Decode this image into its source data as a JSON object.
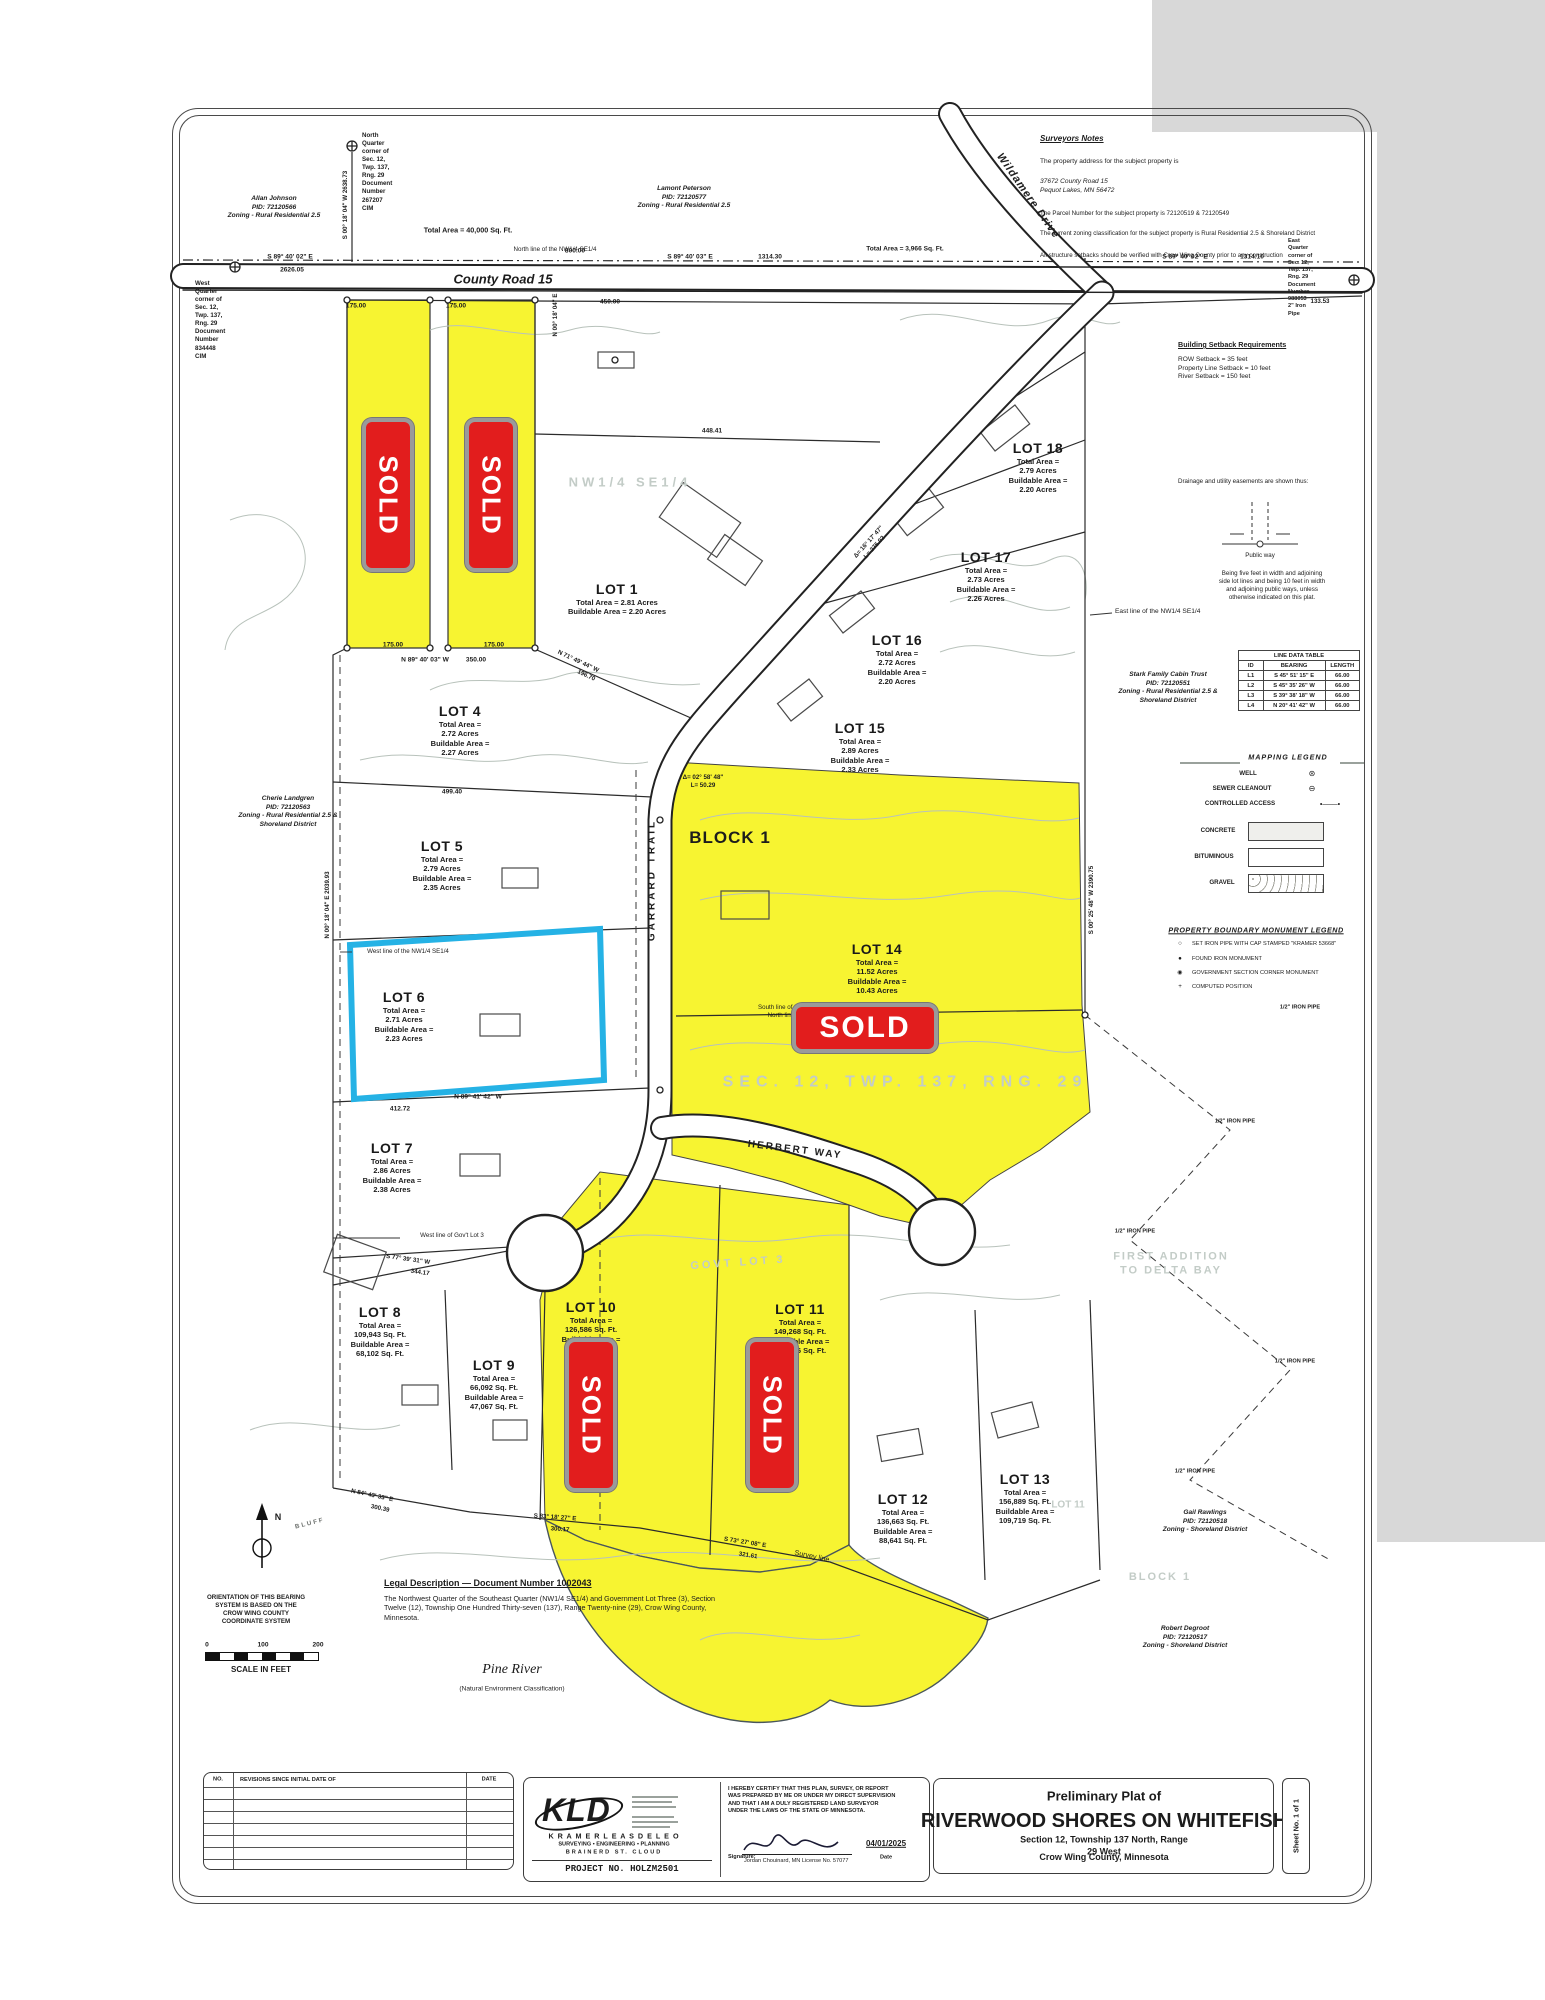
{
  "meta": {
    "title_block": {
      "pre": "Preliminary Plat of",
      "main": "RIVERWOOD SHORES ON WHITEFISH",
      "sub1": "Section 12, Township 137 North, Range 29 West",
      "sub2": "Crow Wing County, Minnesota"
    },
    "sheet_no": "Sheet No. 1 of 1"
  },
  "firm": {
    "kld": "KLD",
    "name": "K R A M E R    L E A S    D E L E O",
    "services": "SURVEYING  •  ENGINEERING  •  PLANNING",
    "offices": "BRAINERD        ST. CLOUD",
    "project": "PROJECT NO.   HOLZM2501",
    "cert": "I HEREBY CERTIFY THAT THIS PLAN, SURVEY, OR REPORT\nWAS PREPARED BY ME OR UNDER MY DIRECT SUPERVISION\nAND THAT I AM A DULY REGISTERED LAND SURVEYOR\nUNDER THE LAWS OF THE  STATE OF MINNESOTA.",
    "sig_label": "Signature:",
    "sig_name": "Jordan Chouinard,  MN License No. 57077",
    "date_value": "04/01/2025",
    "date_label": "Date"
  },
  "revisions": {
    "no": "NO.",
    "desc": "REVISIONS SINCE INITIAL DATE OF",
    "date": "DATE"
  },
  "surveyor": {
    "title": "Surveyors Notes",
    "l1": "The property address for the subject property is",
    "l2": "37672 County Road 15\nPequot Lakes, MN 56472",
    "l3": "The Parcel Number for the subject property is 72120519 & 72120549",
    "l4": "The current zoning classification for the subject property is Rural Residential 2.5 & Shoreland District",
    "l5": "All structure setbacks should be verified with Crow Wing County prior to any construction"
  },
  "setbacks": {
    "title": "Building Setback Requirements",
    "lines": "ROW Setback = 35 feet\nProperty Line Setback = 10 feet\nRiver Setback = 150 feet"
  },
  "easement": {
    "intro": "Drainage and utility easements are shown thus:",
    "public_way": "Public way",
    "note": "Being five feet in width and adjoining\nside lot lines and being 10 feet in width\nand adjoining public ways, unless\notherwise indicated on this plat."
  },
  "line_table": {
    "title": "LINE DATA TABLE",
    "h0": "ID",
    "h1": "BEARING",
    "h2": "LENGTH",
    "rows": [
      [
        "L1",
        "S 45° 51' 15\" E",
        "66.00"
      ],
      [
        "L2",
        "S 45° 35' 26\" W",
        "66.00"
      ],
      [
        "L3",
        "S 39° 38' 18\" W",
        "66.00"
      ],
      [
        "L4",
        "N 20° 41' 42\" W",
        "66.00"
      ]
    ]
  },
  "map_legend": {
    "title": "MAPPING LEGEND",
    "well": "WELL",
    "sewer": "SEWER CLEANOUT",
    "access": "CONTROLLED ACCESS",
    "concrete": "CONCRETE",
    "bituminous": "BITUMINOUS",
    "gravel": "GRAVEL"
  },
  "mon_legend": {
    "title": "PROPERTY BOUNDARY MONUMENT LEGEND",
    "i1": "SET IRON PIPE WITH CAP STAMPED \"KRAMER 53668\"",
    "i2": "FOUND IRON MONUMENT",
    "i3": "GOVERNMENT SECTION CORNER MONUMENT",
    "i4": "COMPUTED POSITION"
  },
  "legal": {
    "title": "Legal Description — Document Number 1002043",
    "body": "The Northwest Quarter of the Southeast Quarter (NW1/4 SE1/4) and Government Lot Three (3), Section Twelve (12), Township One Hundred Thirty-seven (137), Range Twenty-nine (29), Crow Wing County, Minnesota."
  },
  "orientation": "ORIENTATION OF THIS BEARING\nSYSTEM IS BASED ON THE\nCROW WING COUNTY\nCOORDINATE SYSTEM",
  "scale": {
    "t0": "0",
    "t1": "100",
    "t2": "200",
    "label": "SCALE IN FEET"
  },
  "sold": {
    "label": "SOLD"
  },
  "compass": {
    "n": "N"
  },
  "lots": [
    {
      "name": "LOT 1",
      "areas": "Total Area = 2.81 Acres\nBuildable Area = 2.20 Acres"
    },
    {
      "name": "LOT 4",
      "areas": "Total Area =\n2.72 Acres\nBuildable Area =\n2.27 Acres"
    },
    {
      "name": "LOT 5",
      "areas": "Total Area =\n2.79 Acres\nBuildable Area =\n2.35 Acres"
    },
    {
      "name": "LOT 6",
      "areas": "Total Area =\n2.71 Acres\nBuildable Area =\n2.23 Acres"
    },
    {
      "name": "LOT 7",
      "areas": "Total Area =\n2.86 Acres\nBuildable Area =\n2.38 Acres"
    },
    {
      "name": "LOT 8",
      "areas": "Total Area =\n109,943 Sq. Ft.\nBuildable Area =\n68,102 Sq. Ft."
    },
    {
      "name": "LOT 9",
      "areas": "Total Area =\n66,092 Sq. Ft.\nBuildable Area =\n47,067 Sq. Ft."
    },
    {
      "name": "LOT 10",
      "areas": "Total Area =\n126,586 Sq. Ft.\nBuildable Area ="
    },
    {
      "name": "LOT 11",
      "areas": "Total Area =\n149,268 Sq. Ft.\nBuildable Area =\n104,756 Sq. Ft."
    },
    {
      "name": "LOT 12",
      "areas": "Total Area =\n136,663 Sq. Ft.\nBuildable Area =\n88,641 Sq. Ft."
    },
    {
      "name": "LOT 13",
      "areas": "Total Area =\n156,889 Sq. Ft.\nBuildable Area =\n109,719 Sq. Ft."
    },
    {
      "name": "LOT 14",
      "areas": "Total Area =\n11.52 Acres\nBuildable Area =\n10.43 Acres"
    },
    {
      "name": "LOT 15",
      "areas": "Total Area =\n2.89 Acres\nBuildable Area =\n2.33 Acres"
    },
    {
      "name": "LOT 16",
      "areas": "Total Area =\n2.72 Acres\nBuildable Area =\n2.20 Acres"
    },
    {
      "name": "LOT 17",
      "areas": "Total Area =\n2.73 Acres\nBuildable Area =\n2.26 Acres"
    },
    {
      "name": "LOT 18",
      "areas": "Total Area =\n2.79 Acres\nBuildable Area =\n2.20 Acres"
    }
  ],
  "t": {
    "corner_n": "North Quarter corner of\nSec. 12, Twp. 137, Rng. 29\nDocument Number 267207\nCIM",
    "corner_w": "West Quarter corner of\nSec. 12, Twp. 137, Rng. 29\nDocument Number 834448\nCIM",
    "corner_e": "East Quarter corner of\nSec. 12, Twp. 137, Rng. 29\nDocument Number 988053\n2\" Iron Pipe",
    "allan": "Allan Johnson\nPID: 72120566\nZoning - Rural Residential 2.5",
    "lamont": "Lamont Peterson\nPID: 72120577\nZoning - Rural Residential 2.5",
    "cherie": "Cherie Landgren\nPID: 72120563\nZoning - Rural Residential 2.5 &\nShoreland District",
    "stark": "Stark Family Cabin Trust\nPID: 72120551\nZoning - Rural Residential 2.5 &\nShoreland District",
    "gail": "Gail Rawlings\nPID: 72120518\nZoning - Shoreland District",
    "robert": "Robert Degroot\nPID: 72120517\nZoning - Shoreland District",
    "county_road": "County Road 15",
    "garrard": "GARRARD TRAIL",
    "herbert": "HERBERT WAY",
    "wildamere": "Wildamere Drive",
    "road_area1": "Total Area = 40,000 Sq. Ft.",
    "road_area2": "Total Area = 3,966 Sq. Ft.",
    "north_line": "North line of the NW1/4 SE1/4",
    "south_line": "South line of the NW1/4 SE1/4\nNorth line of Gov't Lot 2",
    "east_line": "East line of the NW1/4 SE1/4",
    "west_line_nw": "West line of the NW1/4 SE1/4",
    "west_govt3": "West line of Gov't Lot 3",
    "nw_se": "NW1/4   SE1/4",
    "sec_twp": "SEC. 12,   TWP. 137,   RNG. 29",
    "block1": "BLOCK 1",
    "block1_faded": "BLOCK 1",
    "govt_lot3": "GOVT LOT 3",
    "first_addition": "FIRST ADDITION\nTO DELTA BAY",
    "lot11_faded": "LOT 11",
    "pine_river": "Pine River",
    "pine_sub": "(Natural Environment Classification)",
    "bluff": "BLUFF",
    "survey_line": "Survey line",
    "iron_pipe": "1/2\" IRON PIPE",
    "d_s894002e": "S 89° 40' 02\" E",
    "d_2626": "2626.05",
    "d_800": "800.00",
    "d_s894003e": "S 89° 40' 03\" E",
    "d_131430": "1314.30",
    "d_131410": "1314.10",
    "d_133": "133.53",
    "d_450": "450.00",
    "d_n0018e": "N 00° 18' 04\" E",
    "d_175": "175.00",
    "d_n8940w": "N 89° 40' 03\" W",
    "d_350": "350.00",
    "d_2638": "S 00° 18' 04\" W   2638.73",
    "d_2039": "N 00° 18' 04\" E   2039.93",
    "d_2390": "S 00° 25' 48\" W   2390.75",
    "d_448": "448.41",
    "d_n7149w": "N 71° 49' 44\" W",
    "d_196": "196.70",
    "d_499": "499.40",
    "d_n8941w": "N 89° 41' 42\" W",
    "d_412": "412.72",
    "d_s7739w": "S 77° 39' 31\" W",
    "d_344": "344.17",
    "d_n8443e": "N 84° 43' 33\" E",
    "d_30039": "300.39",
    "d_s8318e": "S 83° 18' 27\" E",
    "d_30017": "300.17",
    "d_s7327e": "S 73° 27' 08\" E",
    "d_321": "321.61",
    "d_delta1": "Δ= 02° 58' 48\"\nL= 50.29",
    "d_delta2": "Δ= 16° 17' 47\"\nL= 275.02"
  }
}
